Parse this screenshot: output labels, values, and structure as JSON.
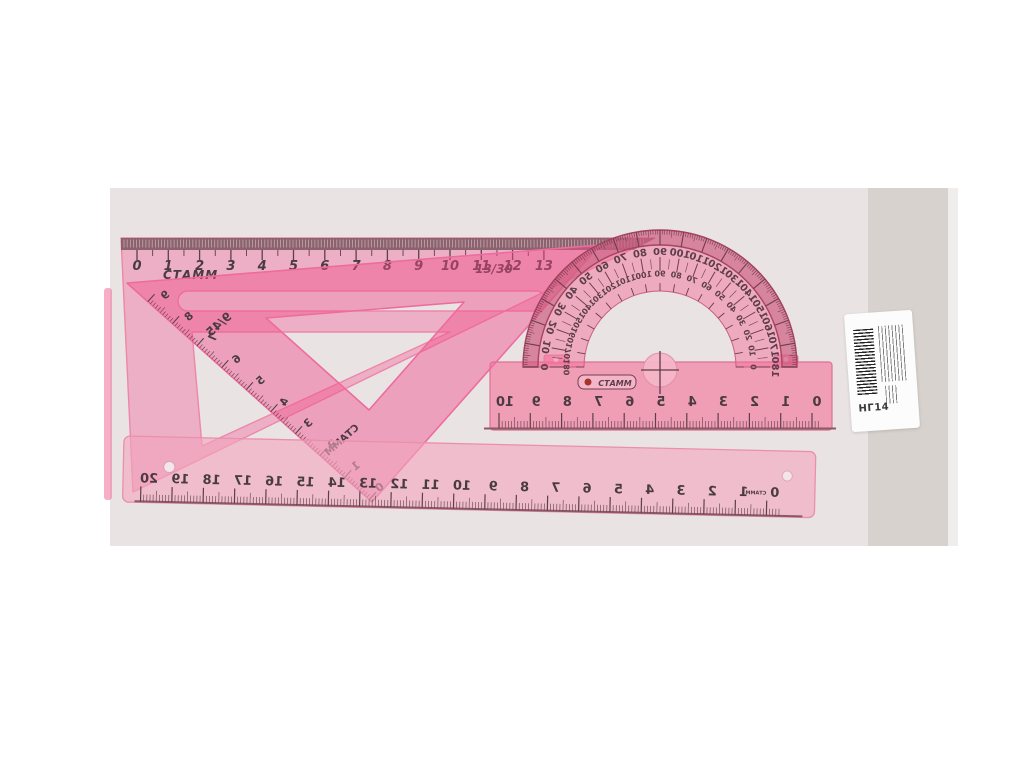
{
  "product_photo": {
    "description": "pink plastic geometry set on gray backdrop",
    "colors": {
      "photo_bg": "#e9e4e3",
      "side_strip": "#d8d2ce",
      "plastic_bright": "#f2508c",
      "plastic_medium": "#f0609a",
      "plastic_pale": "#f2a4bd",
      "rim_rose": "#b84f70",
      "ink": "#4a3a42",
      "tick_ink": "#5d4049"
    }
  },
  "triangle_13_30": {
    "brand": "СТАММ",
    "designation": "13/30",
    "cm_numbers": [
      "0",
      "1",
      "2",
      "3",
      "4",
      "5",
      "6",
      "7",
      "8",
      "9",
      "10",
      "11",
      "12",
      "13"
    ]
  },
  "triangle_9_45": {
    "brand": "СТАММ",
    "designation": "9/45",
    "cm_numbers": [
      "9",
      "8",
      "7",
      "6",
      "5",
      "4",
      "3",
      "2",
      "1",
      "0"
    ]
  },
  "protractor": {
    "brand": "СТАММ",
    "outer_degrees": [
      0,
      10,
      20,
      30,
      40,
      50,
      60,
      70,
      80,
      90,
      100,
      110,
      120,
      130,
      140,
      150,
      160,
      170,
      180
    ],
    "inner_degrees": [
      180,
      170,
      160,
      150,
      140,
      130,
      120,
      110,
      100,
      90,
      80,
      70,
      60,
      50,
      40,
      30,
      20,
      10,
      0
    ],
    "base_cm_numbers": [
      "10",
      "9",
      "8",
      "7",
      "6",
      "5",
      "4",
      "3",
      "2",
      "1",
      "0"
    ]
  },
  "ruler_20cm": {
    "brand": "СТАММ",
    "cm_numbers": [
      "20",
      "19",
      "18",
      "17",
      "16",
      "15",
      "14",
      "13",
      "12",
      "11",
      "10",
      "9",
      "8",
      "7",
      "6",
      "5",
      "4",
      "3",
      "2",
      "1",
      "0"
    ]
  },
  "label": {
    "code": "НГ14"
  }
}
